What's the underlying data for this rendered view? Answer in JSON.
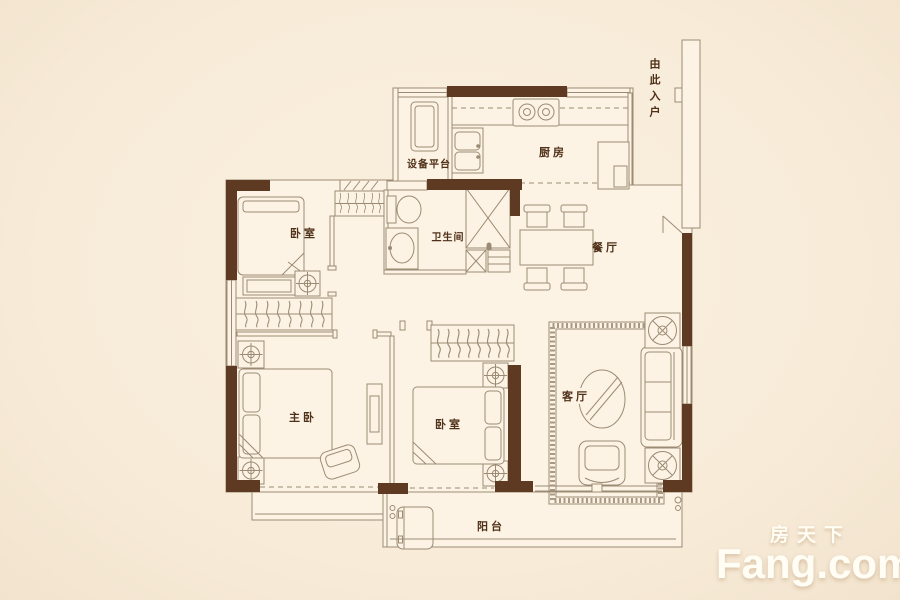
{
  "colors": {
    "background": "#f8ecd9",
    "floor": "#fcf3e4",
    "wall": "#5e3a22",
    "line": "#9c8b74",
    "label": "#4f3018",
    "rugline": "#a89a84",
    "watermark": "#fffdf4"
  },
  "rooms": {
    "equipment_platform": "设备平台",
    "kitchen": "厨房",
    "bedroom_north": "卧室",
    "bathroom": "卫生间",
    "dining": "餐厅",
    "master_bedroom": "主卧",
    "bedroom_south": "卧室",
    "living_room": "客厅",
    "balcony": "阳台",
    "entry": "由此入户"
  },
  "watermark": {
    "brand_cn": "房天下",
    "brand_en": "Fang.com"
  }
}
